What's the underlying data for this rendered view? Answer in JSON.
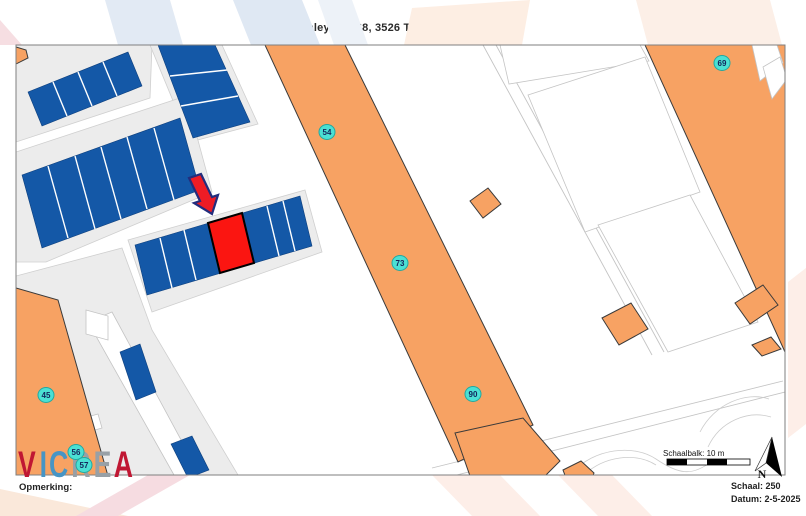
{
  "title": "Stanleylaan 68, 3526 TM Utrecht 30199849",
  "map": {
    "house_labels": [
      "54",
      "73",
      "90",
      "69",
      "45",
      "56",
      "57"
    ]
  },
  "legend": {
    "scalebar_label": "Schaalbalk: 10 m",
    "north_label": "N"
  },
  "footer": {
    "remark_label": "Opmerking:",
    "scale_text": "Schaal: 250",
    "date_text": "Datum: 2-5-2025"
  },
  "logo": {
    "letters": [
      "V",
      "I",
      "C",
      "R",
      "E",
      "A"
    ]
  },
  "colors": {
    "orange": "#f7a263",
    "blue": "#1458a7",
    "red": "#fb1511",
    "cyan": "#4be0d4",
    "arrow_red": "#ee1c25",
    "arrow_outline": "#232d7d",
    "logo_red": "#c01733",
    "logo_blue": "#4795c5",
    "logo_gray": "#98a0a6",
    "parcel_gray": "#ececec"
  }
}
